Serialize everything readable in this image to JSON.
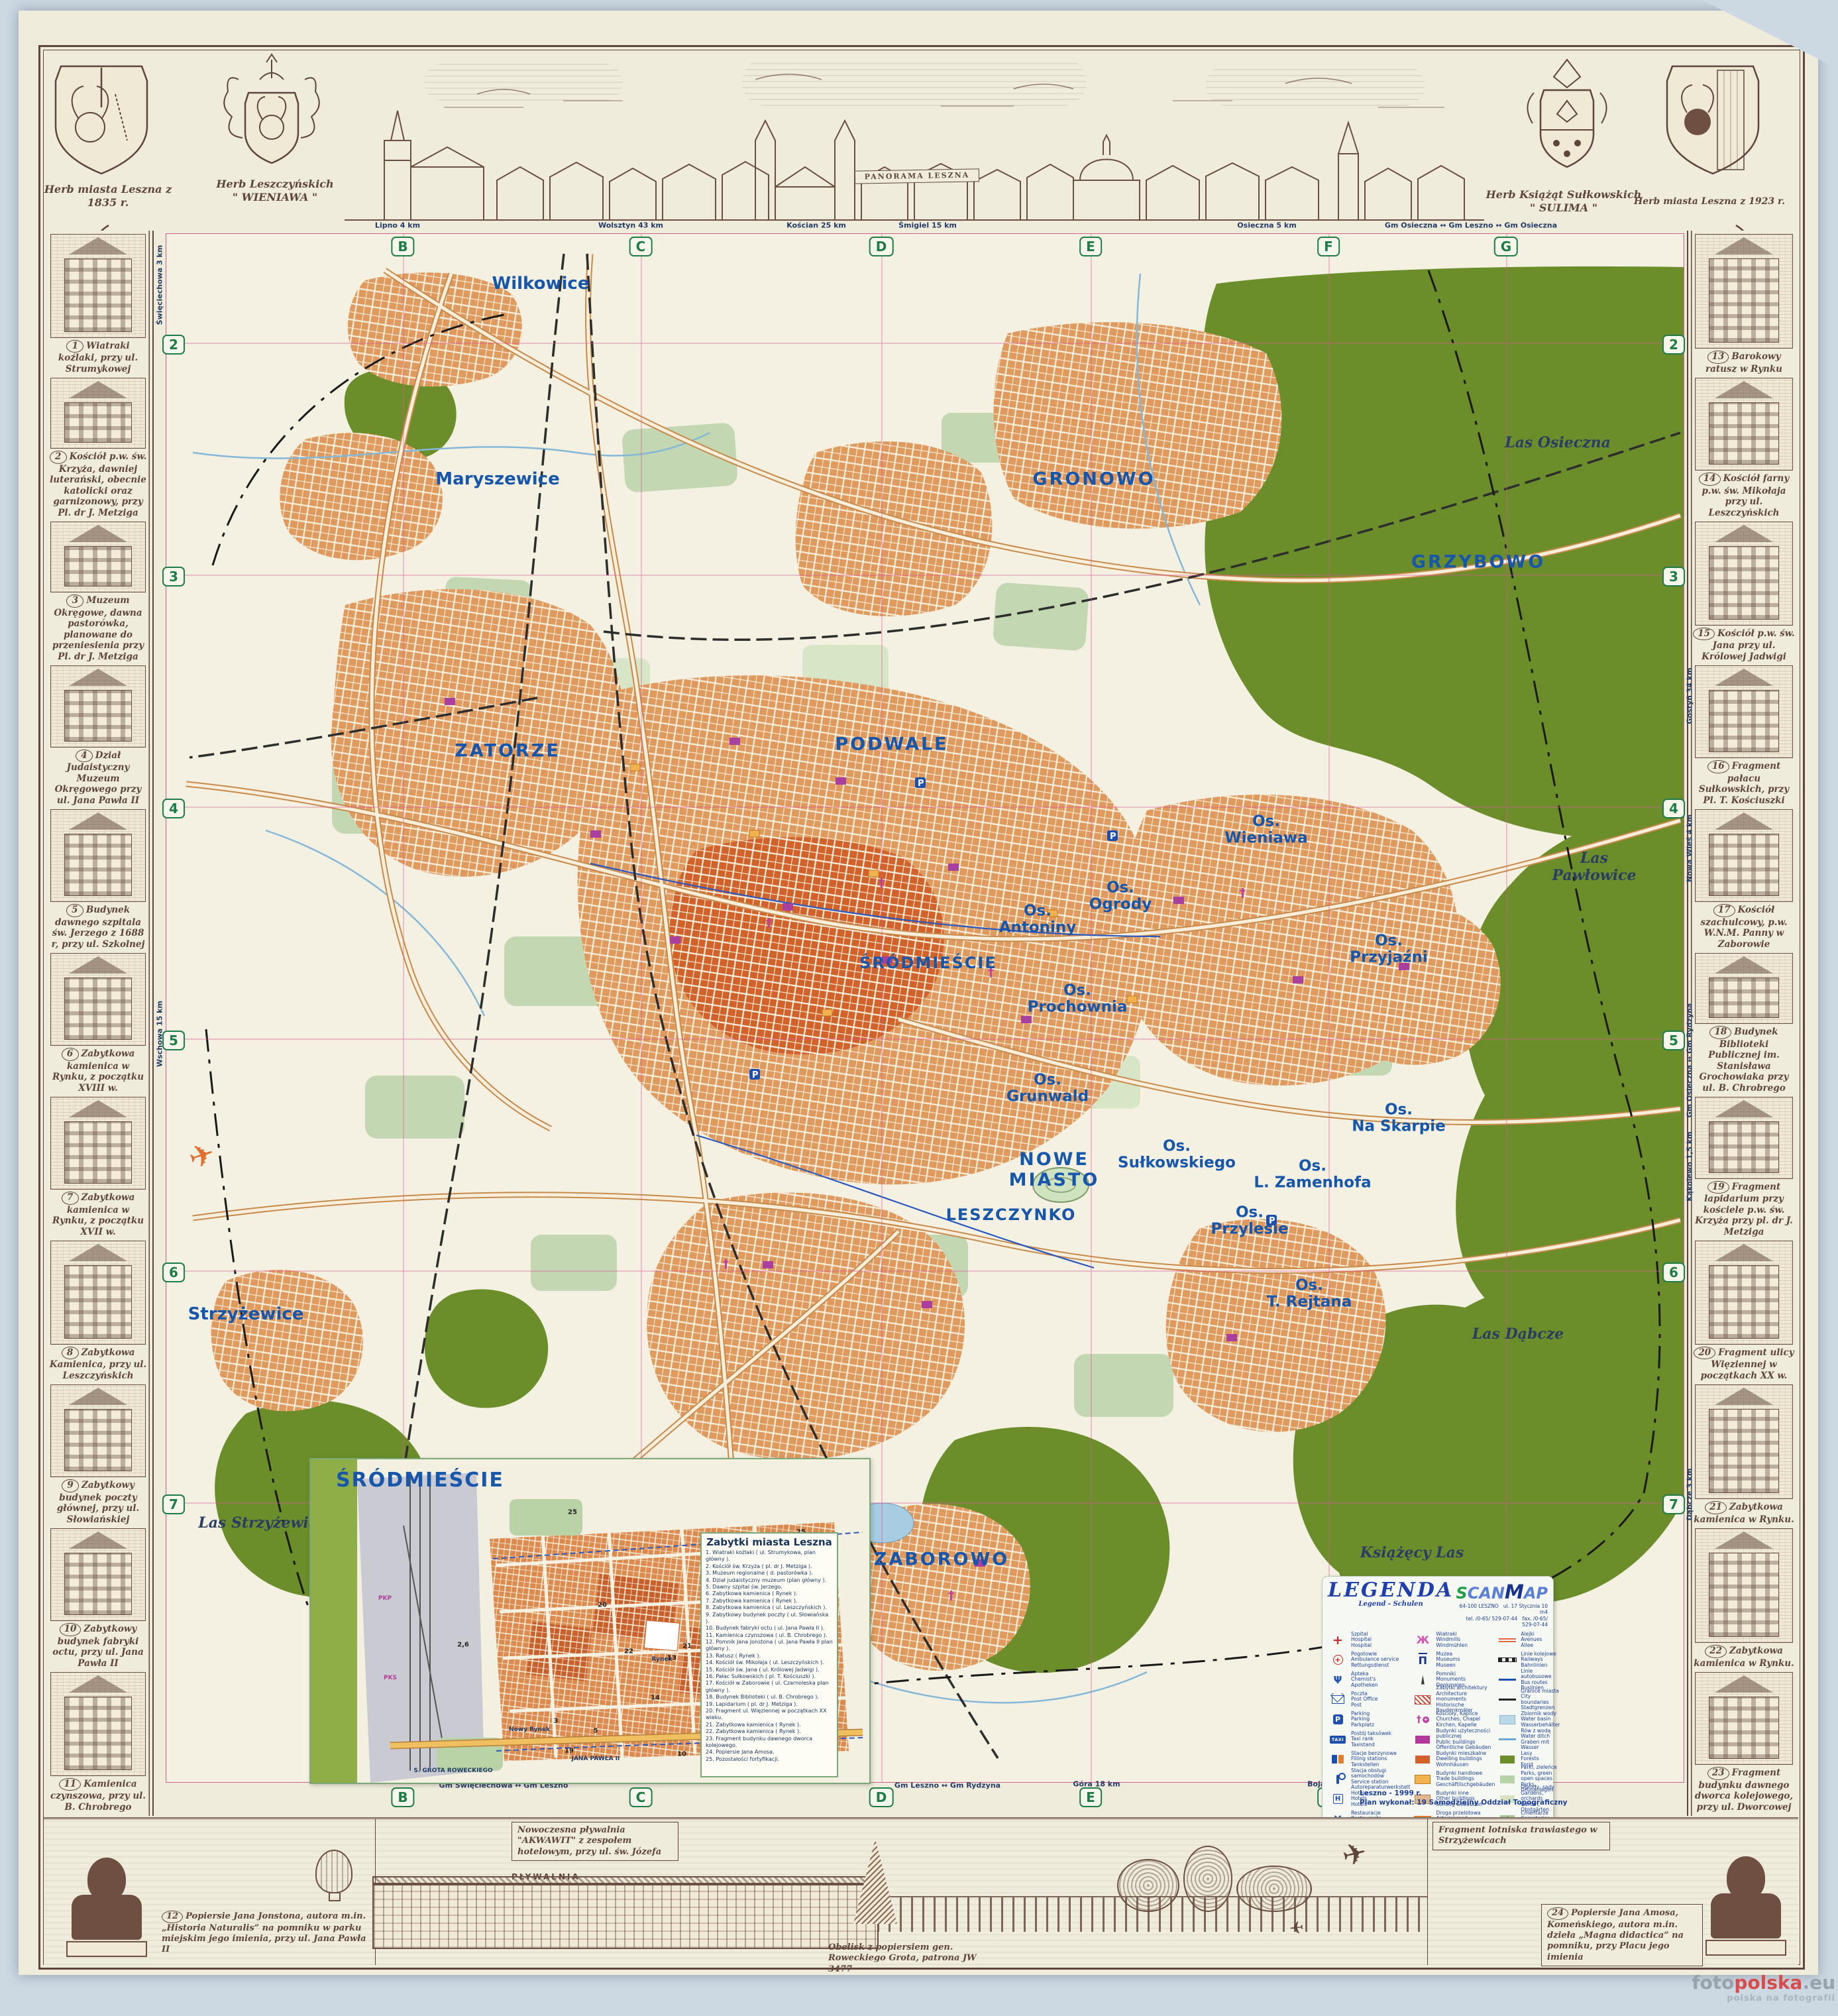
{
  "top": {
    "herb1_caption": "Herb miasta Leszna z 1835 r.",
    "herb2_caption_1": "Herb Leszczyńskich",
    "herb2_caption_2": "\" WIENIAWA \"",
    "herb3_caption_1": "Herb Książąt Sułkowskich",
    "herb3_caption_2": "\" SULIMA \"",
    "herb4_caption": "Herb miasta Leszna z 1923 r.",
    "panorama_label": "PANORAMA LESZNA"
  },
  "left_items": [
    {
      "num": "1",
      "caption": "Wiatraki koźlaki, przy ul. Strumykowej"
    },
    {
      "num": "2",
      "caption": "Kościół p.w. św. Krzyża, dawniej luterański, obecnie katolicki oraz garnizonowy, przy Pl. dr J. Metziga"
    },
    {
      "num": "3",
      "caption": "Muzeum Okręgowe, dawna pastorówka, planowane do przeniesienia przy Pl. dr J. Metziga"
    },
    {
      "num": "4",
      "caption": "Dział Judaistyczny Muzeum Okręgowego przy ul. Jana Pawła II"
    },
    {
      "num": "5",
      "caption": "Budynek dawnego szpitala św. Jerzego z 1688 r, przy ul. Szkolnej"
    },
    {
      "num": "6",
      "caption": "Zabytkowa kamienica w Rynku, z początku XVIII w."
    },
    {
      "num": "7",
      "caption": "Zabytkowa kamienica w Rynku, z początku XVII w."
    },
    {
      "num": "8",
      "caption": "Zabytkowa Kamienica, przy ul. Leszczyńskich"
    },
    {
      "num": "9",
      "caption": "Zabytkowy budynek poczty głównej, przy ul. Słowiańskiej"
    },
    {
      "num": "10",
      "caption": "Zabytkowy budynek fabryki octu, przy ul. Jana Pawła II"
    },
    {
      "num": "11",
      "caption": "Kamienica czynszowa, przy ul. B. Chrobrego"
    }
  ],
  "right_items": [
    {
      "num": "13",
      "caption": "Barokowy ratusz w Rynku"
    },
    {
      "num": "14",
      "caption": "Kościół farny p.w. św. Mikołaja przy ul. Leszczyńskich"
    },
    {
      "num": "15",
      "caption": "Kościół p.w. św. Jana przy ul. Królowej Jadwigi"
    },
    {
      "num": "16",
      "caption": "Fragment pałacu Sułkowskich, przy Pl. T. Kościuszki"
    },
    {
      "num": "17",
      "caption": "Kościół szachulcowy, p.w. W.N.M. Panny w Zaborowie"
    },
    {
      "num": "18",
      "caption": "Budynek Biblioteki Publicznej im. Stanisława Grochowiaka przy ul. B. Chrobrego"
    },
    {
      "num": "19",
      "caption": "Fragment lapidarium przy kościele p.w. św. Krzyża przy pl. dr J. Metziga"
    },
    {
      "num": "20",
      "caption": "Fragment ulicy Więziennej w początkach XX w."
    },
    {
      "num": "21",
      "caption": "Zabytkowa kamienica w Rynku."
    },
    {
      "num": "22",
      "caption": "Zabytkowa kamienica w Rynku."
    },
    {
      "num": "23",
      "caption": "Fragment budynku dawnego dworca kolejowego, przy ul. Dworcowej"
    }
  ],
  "bottom": {
    "item12_num": "12",
    "item12_caption": "Popiersie Jana Jonstona, autora m.in. „Historia Naturalis” na pomniku w parku miejskim jego imienia, przy ul. Jana Pawła II",
    "akwawit_caption": "Nowoczesna pływalnia \"AKWAWIT\" z zespołem hotelowym, przy ul. św. Józefa",
    "plywalnia_label": "PŁYWALNIA",
    "obelisk_caption": "Obelisk z popiersiem gen. Roweckiego Grota, patrona JW 3477",
    "lotnisko_caption": "Fragment lotniska trawiastego w Strzyżewicach",
    "item24_num": "24",
    "item24_caption": "Popiersie Jana Amosa, Komeńskiego, autora m.in. dzieła „Magna didactica” na pomniku, przy Placu jego imienia"
  },
  "map": {
    "grid_cols": [
      "B",
      "C",
      "D",
      "E",
      "F",
      "G"
    ],
    "grid_rows": [
      "2",
      "3",
      "4",
      "5",
      "6",
      "7"
    ],
    "districts": [
      "Wilkowice",
      "Maryszewice",
      "GRONOWO",
      "GRZYBOWO",
      "ZATORZE",
      "PODWALE",
      "Os.\nAntoniny",
      "Os.\nOgrody",
      "Os.\nWieniawa",
      "Os.\nPrzyjaźni",
      "Os.\nProchownia",
      "ŚRÓDMIEŚCIE",
      "Os.\nGrunwald",
      "NOWE\nMIASTO",
      "Os.\nSułkowskiego",
      "Os.\nNa Skarpie",
      "Os.\nPrzylesie",
      "Os.\nL. Zamenhofa",
      "LESZCZYNKO",
      "Os.\nT. Rejtana",
      "Strzyżewice",
      "ZABOROWO"
    ],
    "forests": [
      "Las Osieczna",
      "Las Pawłowice",
      "Las Dąbcze",
      "Książęcy Las",
      "Las Strzyżewicki"
    ],
    "edge_top": [
      "Lipno 4 km",
      "Wolsztyn 43 km",
      "Kościan 25 km",
      "Śmigiel 15 km",
      "Osieczna 5 km",
      "Gm Osieczna ↔ Gm Leszno ↔ Gm Osieczna"
    ],
    "edge_bottom": [
      "Gm Święciechowa ↔ Gm Leszno",
      "Gm Leszno ↔ Gm Rydzyna",
      "Góra 18 km",
      "Bojanowo 16,5 km"
    ],
    "edge_left": [
      "Święciechowa 3 km",
      "Wschowa 15 km"
    ],
    "edge_right": [
      "Gostyń 34 km",
      "Nowa Wieś 4 km",
      "Gm Osieczna ↔ Gm Rydzyna",
      "Kąkolewo 1,5 km",
      "Dąbcze 3 km"
    ],
    "credits1": "Leszno - 1999 r.",
    "credits2": "Plan wykonał: 19 Samodzielny Oddział Topograficzny"
  },
  "inset": {
    "title": "ŚRÓDMIEŚCIE",
    "labels": [
      "Rynek",
      "Nowy Rynek",
      "PKP",
      "PKS",
      "JANA PAWŁA II",
      "S. GROTA ROWECKIEGO"
    ],
    "map_numbers": [
      "25",
      "25",
      "20",
      "22",
      "13",
      "21",
      "16",
      "18",
      "14",
      "15",
      "19",
      "24",
      "3",
      "5",
      "10",
      "2,6"
    ],
    "list_title": "Zabytki miasta Leszna",
    "items": [
      "1. Wiatraki koźlaki ( ul. Strumykowa, plan główny ).",
      "2. Kościół św. Krzyża ( pl. dr J. Metziga ).",
      "3. Muzeum regionalne ( d. pastorówka ).",
      "4. Dział judaistyczny muzeum (plan główny ).",
      "5. Dawny szpital św. Jerzego.",
      "6. Zabytkowa kamienica ( Rynek ).",
      "7. Zabytkowa kamienica ( Rynek ).",
      "8. Zabytkowa kamienica ( ul. Leszczyńskich ).",
      "9. Zabytkowy budynek poczty ( ul. Słowiańska ).",
      "10. Budynek fabryki octu ( ul. Jana Pawła II ).",
      "11. Kamienica czynszowa ( ul. B. Chrobrego ).",
      "12. Pomnik Jana Jonstona ( ul. Jana Pawła II plan główny ).",
      "13. Ratusz ( Rynek ).",
      "14. Kościół św. Mikołaja ( ul. Leszczyńskich ).",
      "15. Kościół św. Jana ( ul. Królowej Jadwigi ).",
      "16. Pałac Sułkowskich ( pl. T. Kościuszki ).",
      "17. Kościół w Zaborowie ( ul. Czarnoleska plan główny ).",
      "18. Budynek Biblioteki ( ul. B. Chrobrego ).",
      "19. Lapidarium ( pl. dr J. Metziga ).",
      "20. Fragment ul. Więziennej w początkach XX wieku.",
      "21. Zabytkowa kamienica ( Rynek ).",
      "22. Zabytkowa kamienica ( Rynek ).",
      "23. Fragment budynku dawnego dworca kolejowego.",
      "24. Popiersie Jana Amosa.",
      "25. Pozostałości fortyfikacji."
    ]
  },
  "legend": {
    "title": "LEGENDA",
    "subtitle": "Legend - Schulen",
    "brand_s": "S",
    "brand_can": "CAN",
    "brand_m": "M",
    "brand_ap": "AP",
    "brand_addr1": "64-100 LESZNO",
    "brand_addr2": "ul. 17 Stycznia 10 m4",
    "brand_tel": "tel. /0-65/ 529-07-44",
    "brand_fax": "fax. /0-65/ 529-07-44",
    "col1": [
      {
        "icon": "hospital",
        "pl": "Szpital",
        "en": "Hospital",
        "de": "Hospital"
      },
      {
        "icon": "ambulance",
        "pl": "Pogotowie",
        "en": "Ambulance service",
        "de": "Rettungsdienst"
      },
      {
        "icon": "pharmacy",
        "pl": "Apteka",
        "en": "Chemist's",
        "de": "Apotheken"
      },
      {
        "icon": "post",
        "pl": "Poczta",
        "en": "Post Office",
        "de": "Post"
      },
      {
        "icon": "parking",
        "pl": "Parking",
        "en": "Parking",
        "de": "Parkplatz"
      },
      {
        "icon": "taxi",
        "pl": "Postój taksówek",
        "en": "Taxi rank",
        "de": "Taxistand"
      },
      {
        "icon": "fuel",
        "pl": "Stacje benzynowe",
        "en": "Filling stations",
        "de": "Tankstellen"
      },
      {
        "icon": "service",
        "pl": "Stacja obsługi samochodów",
        "en": "Service station",
        "de": "Autoreparaturwerkstatt"
      },
      {
        "icon": "hotel",
        "pl": "Hotele",
        "en": "Hotels",
        "de": "Hotels"
      },
      {
        "icon": "restaurant",
        "pl": "Restauracje",
        "en": "Restaurants",
        "de": "Restaurants"
      },
      {
        "icon": "fountain",
        "pl": "Fontanny",
        "en": "Fountains",
        "de": "Fontänen"
      }
    ],
    "col2": [
      {
        "icon": "windmill",
        "pl": "Wiatraki",
        "en": "Windmills",
        "de": "Windmühlen"
      },
      {
        "icon": "museum",
        "pl": "Muzea",
        "en": "Museums",
        "de": "Museen"
      },
      {
        "icon": "monument",
        "pl": "Pomniki",
        "en": "Monuments",
        "de": "Denkmalen"
      },
      {
        "icon": "architecture",
        "pl": "Zabytki architektury",
        "en": "Architecture monuments",
        "de": "Historische Baudenkmäler"
      },
      {
        "icon": "church",
        "pl": "Kościoły, Kaplice",
        "en": "Churches, Chapel",
        "de": "Kirchen, Kapelle"
      },
      {
        "icon": "public-building",
        "pl": "Budynki użyteczności publicznej",
        "en": "Public buildings",
        "de": "Öffentliche Gebäuden"
      },
      {
        "icon": "dwelling",
        "pl": "Budynki mieszkalne",
        "en": "Dwelling buildings",
        "de": "Wohnhäusen"
      },
      {
        "icon": "trade",
        "pl": "Budynki handlowe",
        "en": "Trade buildings",
        "de": "Geschäftlischgebäuden"
      },
      {
        "icon": "other-building",
        "pl": "Budynki inne",
        "en": "Other buildings",
        "de": "Sonstig Gebäuden"
      },
      {
        "icon": "arterial",
        "pl": "Droga przelotowa",
        "en": "Arterial road",
        "de": "Durchfahrtsstrassen"
      },
      {
        "icon": "streets",
        "pl": "Ulice",
        "en": "Streets",
        "de": "Strassen"
      }
    ],
    "col3": [
      {
        "icon": "avenue",
        "pl": "Alejki",
        "en": "Avenues",
        "de": "Allee"
      },
      {
        "icon": "railway",
        "pl": "Linie kolejowe",
        "en": "Railways",
        "de": "Bahnlinien"
      },
      {
        "icon": "bus",
        "pl": "Linie autobusowe",
        "en": "Bus routes",
        "de": "Buslinien"
      },
      {
        "icon": "boundary",
        "pl": "Granice miasta",
        "en": "City boundaries",
        "de": "Stadtgrenzen"
      },
      {
        "icon": "water-basin",
        "pl": "Zbiornik wody",
        "en": "Water basin",
        "de": "Wasserbehälter"
      },
      {
        "icon": "ditch",
        "pl": "Rów z wodą",
        "en": "Water ditch",
        "de": "Graben mit Wasser"
      },
      {
        "icon": "forest",
        "pl": "Lasy",
        "en": "Forests",
        "de": "Forst"
      },
      {
        "icon": "park",
        "pl": "Parki, zieleńce",
        "en": "Parks, green open spaces",
        "de": "Parks, Grünanlagen"
      },
      {
        "icon": "garden",
        "pl": "Ogrody, sady",
        "en": "Gardens, orchards",
        "de": "Gärten, Obstgärten"
      },
      {
        "icon": "cemetery",
        "pl": "Cmentarze",
        "en": "Cemeteries",
        "de": "Friedhöfe"
      }
    ]
  },
  "watermark": {
    "w1a": "foto",
    "w1b": "polska",
    "w1c": ".eu",
    "w2": "polska na fotografii"
  },
  "colors": {
    "forest": "#6b8d2a",
    "urban": "#e09a5e",
    "urban_core": "#d2622a",
    "public_building": "#a93f9f",
    "label_blue": "#1656ab",
    "grid_pink": "#e0559a",
    "marker_green": "#1e7c46",
    "ink": "#5e463c"
  }
}
